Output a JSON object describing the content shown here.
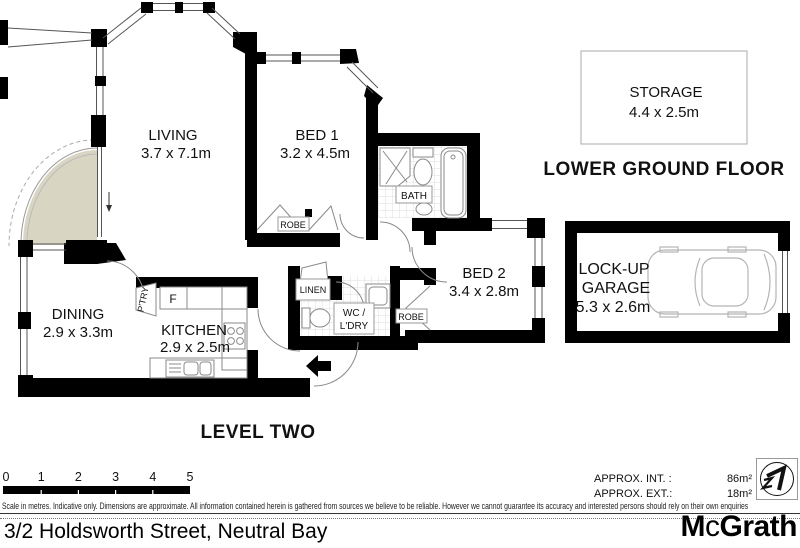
{
  "colors": {
    "wall": "#000000",
    "balcony_fill": "#d9d5c3",
    "fixture_line": "#999999",
    "tile_line": "#dddddd"
  },
  "plan": {
    "level_two_label": "LEVEL TWO",
    "lower_ground_label": "LOWER GROUND FLOOR",
    "rooms": {
      "living": {
        "name": "LIVING",
        "dims": "3.7 x 7.1m"
      },
      "bed1": {
        "name": "BED 1",
        "dims": "3.2 x 4.5m"
      },
      "bed2": {
        "name": "BED 2",
        "dims": "3.4 x 2.8m"
      },
      "dining": {
        "name": "DINING",
        "dims": "2.9 x 3.3m"
      },
      "kitchen": {
        "name": "KITCHEN",
        "dims": "2.9 x 2.5m"
      },
      "storage": {
        "name": "STORAGE",
        "dims": "4.4 x 2.5m"
      },
      "garage": {
        "line1": "LOCK-UP",
        "line2": "GARAGE",
        "dims": "5.3 x 2.6m"
      },
      "bath": {
        "name": "BATH"
      },
      "wc": {
        "line1": "WC /",
        "line2": "L'DRY"
      },
      "linen": {
        "name": "LINEN"
      },
      "robe_bed1": {
        "name": "ROBE"
      },
      "robe_bed2": {
        "name": "ROBE"
      },
      "pantry": {
        "name": "P'TRY"
      },
      "fridge": {
        "name": "F"
      }
    }
  },
  "scale_bar": {
    "ticks": [
      "0",
      "1",
      "2",
      "3",
      "4",
      "5"
    ]
  },
  "footer": {
    "disclaimer": "Scale in metres. Indicative only. Dimensions are approximate. All information contained herein is gathered from sources we believe to be reliable. However we cannot guarantee its accuracy and interested persons should rely on their own enquiries",
    "address": "3/2 Holdsworth Street, Neutral Bay",
    "approx_int_label": "APPROX. INT. :",
    "approx_int_value": "86m²",
    "approx_ext_label": "APPROX. EXT.:",
    "approx_ext_value": "18m²",
    "logo": {
      "part1": "M",
      "part2": "c",
      "part3": "Grath"
    }
  }
}
